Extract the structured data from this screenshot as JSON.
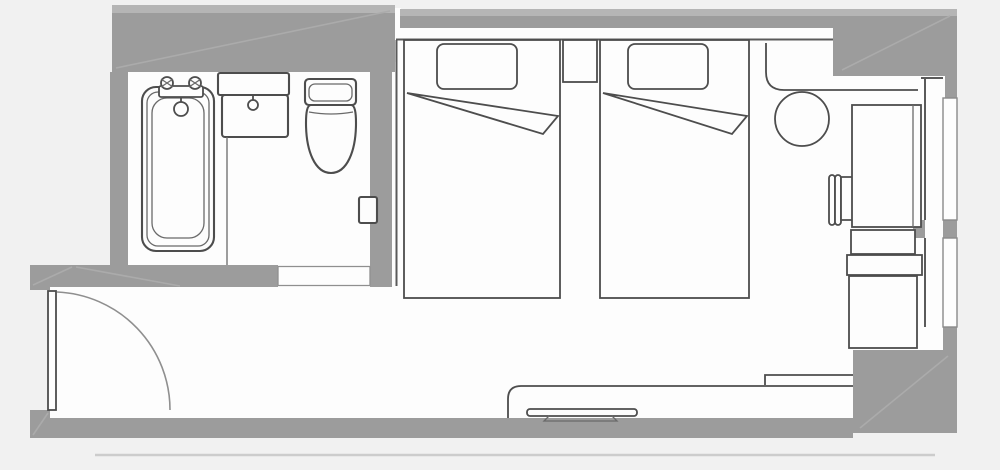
{
  "meta": {
    "type": "floor-plan",
    "description": "hotel guest room floor plan, twin beds with bathroom",
    "visible_text": []
  },
  "palette": {
    "background": "#f1f1f1",
    "floor": "#fdfdfd",
    "wall": "#9c9c9c",
    "wall_light": "#b5b5b5",
    "hatch": "#ababab",
    "line_dark": "#4d4d4d",
    "line_mid": "#6a6a6a",
    "line_light": "#8f8f8f",
    "shadow_line": "#cccccc",
    "window_outline": "#8a8a8a"
  },
  "plan": {
    "rooms": [
      "bathroom",
      "entrance-corridor",
      "bedroom"
    ],
    "architecture": [
      "exterior-walls",
      "bathroom-walls",
      "entrance-door-swing",
      "bathroom-door-opening",
      "window-wall-piers",
      "window-1",
      "window-2"
    ],
    "bathroom_fixtures": [
      "bathtub",
      "bathtub-faucet",
      "vanity-sink",
      "sink-faucet",
      "toilet",
      "wall-switch-panel",
      "wet-area-partition"
    ],
    "bedroom_furniture": [
      "bed-1",
      "pillow-1",
      "sheet-fold-1",
      "nightstand",
      "bed-2",
      "pillow-2",
      "sheet-fold-2",
      "closet-counter",
      "round-table",
      "desk-chair",
      "desk",
      "shelf-unit",
      "cabinet",
      "window-bench",
      "tv-console",
      "television"
    ]
  }
}
